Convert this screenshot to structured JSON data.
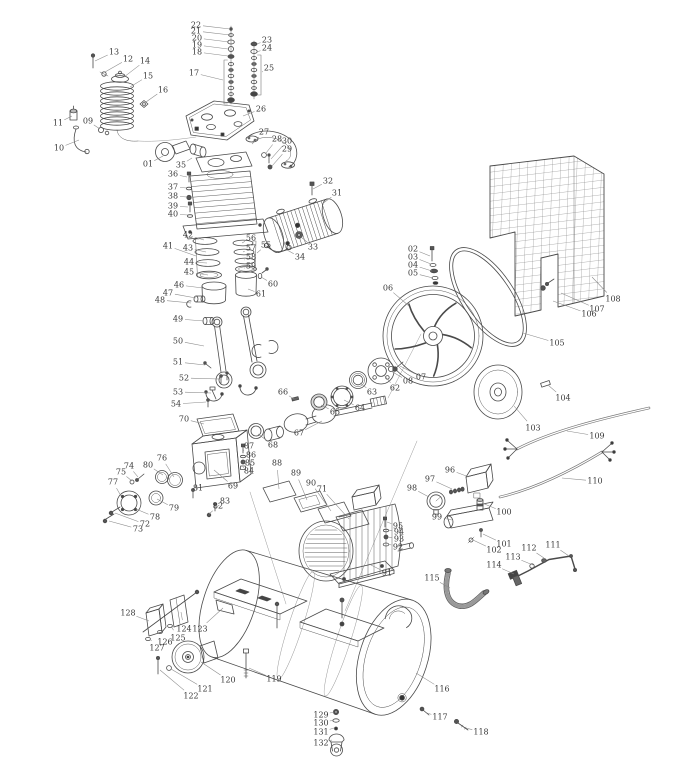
{
  "diagram": {
    "kind": "exploded-parts-diagram",
    "background": "#ffffff",
    "line_color": "#4a4a4a",
    "label_color": "#3a3a3a",
    "callouts": [
      {
        "n": "01",
        "lx": 148,
        "ly": 164,
        "tx": 163,
        "ty": 156
      },
      {
        "n": "02",
        "lx": 413,
        "ly": 249,
        "tx": 430,
        "ty": 256
      },
      {
        "n": "03",
        "lx": 413,
        "ly": 257,
        "tx": 431,
        "ty": 264
      },
      {
        "n": "04",
        "lx": 413,
        "ly": 265,
        "tx": 432,
        "ty": 271
      },
      {
        "n": "05",
        "lx": 413,
        "ly": 273,
        "tx": 433,
        "ty": 278
      },
      {
        "n": "06",
        "lx": 388,
        "ly": 288,
        "tx": 409,
        "ty": 306
      },
      {
        "n": "07",
        "lx": 421,
        "ly": 377,
        "tx": 400,
        "ty": 366
      },
      {
        "n": "08",
        "lx": 408,
        "ly": 381,
        "tx": 391,
        "ty": 371
      },
      {
        "n": "09",
        "lx": 88,
        "ly": 121,
        "tx": 100,
        "ty": 129
      },
      {
        "n": "10",
        "lx": 59,
        "ly": 148,
        "tx": 79,
        "ty": 140
      },
      {
        "n": "11",
        "lx": 58,
        "ly": 123,
        "tx": 72,
        "ty": 116
      },
      {
        "n": "12",
        "lx": 128,
        "ly": 59,
        "tx": 105,
        "ty": 72
      },
      {
        "n": "13",
        "lx": 114,
        "ly": 52,
        "tx": 95,
        "ty": 61
      },
      {
        "n": "14",
        "lx": 145,
        "ly": 61,
        "tx": 124,
        "ty": 77
      },
      {
        "n": "15",
        "lx": 148,
        "ly": 76,
        "tx": 130,
        "ty": 87
      },
      {
        "n": "16",
        "lx": 163,
        "ly": 90,
        "tx": 146,
        "ty": 102
      },
      {
        "n": "17",
        "lx": 194,
        "ly": 73,
        "tx": 223,
        "ty": 80
      },
      {
        "n": "18",
        "lx": 197,
        "ly": 52,
        "tx": 228,
        "ty": 56
      },
      {
        "n": "19",
        "lx": 197,
        "ly": 45,
        "tx": 228,
        "ty": 49
      },
      {
        "n": "20",
        "lx": 197,
        "ly": 38,
        "tx": 229,
        "ty": 42
      },
      {
        "n": "21",
        "lx": 196,
        "ly": 31,
        "tx": 230,
        "ty": 35
      },
      {
        "n": "22",
        "lx": 196,
        "ly": 25,
        "tx": 230,
        "ty": 29
      },
      {
        "n": "23",
        "lx": 267,
        "ly": 40,
        "tx": 257,
        "ty": 44
      },
      {
        "n": "24",
        "lx": 267,
        "ly": 48,
        "tx": 257,
        "ty": 52
      },
      {
        "n": "25",
        "lx": 269,
        "ly": 68,
        "tx": 262,
        "ty": 72
      },
      {
        "n": "26",
        "lx": 261,
        "ly": 109,
        "tx": 243,
        "ty": 116
      },
      {
        "n": "27",
        "lx": 264,
        "ly": 132,
        "tx": 252,
        "ty": 144
      },
      {
        "n": "28",
        "lx": 277,
        "ly": 139,
        "tx": 266,
        "ty": 153
      },
      {
        "n": "29",
        "lx": 287,
        "ly": 149,
        "tx": 272,
        "ty": 166
      },
      {
        "n": "30",
        "lx": 287,
        "ly": 141,
        "tx": 271,
        "ty": 159
      },
      {
        "n": "31",
        "lx": 337,
        "ly": 193,
        "tx": 322,
        "ty": 204
      },
      {
        "n": "32",
        "lx": 328,
        "ly": 181,
        "tx": 313,
        "ty": 189
      },
      {
        "n": "33",
        "lx": 313,
        "ly": 247,
        "tx": 301,
        "ty": 237
      },
      {
        "n": "34",
        "lx": 300,
        "ly": 257,
        "tx": 287,
        "ty": 250
      },
      {
        "n": "35",
        "lx": 181,
        "ly": 165,
        "tx": 192,
        "ty": 158
      },
      {
        "n": "36",
        "lx": 173,
        "ly": 174,
        "tx": 187,
        "ty": 177
      },
      {
        "n": "37",
        "lx": 173,
        "ly": 187,
        "tx": 187,
        "ty": 188
      },
      {
        "n": "38",
        "lx": 173,
        "ly": 196,
        "tx": 187,
        "ty": 197
      },
      {
        "n": "39",
        "lx": 173,
        "ly": 206,
        "tx": 188,
        "ty": 207
      },
      {
        "n": "40",
        "lx": 173,
        "ly": 214,
        "tx": 188,
        "ty": 215
      },
      {
        "n": "41",
        "lx": 168,
        "ly": 246,
        "tx": 196,
        "ty": 256
      },
      {
        "n": "42",
        "lx": 188,
        "ly": 235,
        "tx": 204,
        "ty": 240
      },
      {
        "n": "43",
        "lx": 188,
        "ly": 248,
        "tx": 206,
        "ty": 252
      },
      {
        "n": "44",
        "lx": 189,
        "ly": 262,
        "tx": 207,
        "ty": 263
      },
      {
        "n": "45",
        "lx": 189,
        "ly": 272,
        "tx": 208,
        "ty": 275
      },
      {
        "n": "46",
        "lx": 179,
        "ly": 285,
        "tx": 203,
        "ty": 288
      },
      {
        "n": "47",
        "lx": 168,
        "ly": 293,
        "tx": 196,
        "ty": 298
      },
      {
        "n": "48",
        "lx": 160,
        "ly": 300,
        "tx": 191,
        "ty": 303
      },
      {
        "n": "49",
        "lx": 178,
        "ly": 319,
        "tx": 204,
        "ty": 321
      },
      {
        "n": "50",
        "lx": 178,
        "ly": 341,
        "tx": 204,
        "ty": 346
      },
      {
        "n": "51",
        "lx": 178,
        "ly": 362,
        "tx": 205,
        "ty": 365
      },
      {
        "n": "52",
        "lx": 184,
        "ly": 378,
        "tx": 219,
        "ty": 379
      },
      {
        "n": "53",
        "lx": 178,
        "ly": 392,
        "tx": 211,
        "ty": 393
      },
      {
        "n": "54",
        "lx": 176,
        "ly": 404,
        "tx": 206,
        "ty": 402
      },
      {
        "n": "55",
        "lx": 266,
        "ly": 245,
        "tx": 257,
        "ty": 253
      },
      {
        "n": "56",
        "lx": 251,
        "ly": 238,
        "tx": 242,
        "ty": 243
      },
      {
        "n": "57",
        "lx": 251,
        "ly": 248,
        "tx": 243,
        "ty": 252
      },
      {
        "n": "58",
        "lx": 251,
        "ly": 257,
        "tx": 244,
        "ty": 260
      },
      {
        "n": "59",
        "lx": 251,
        "ly": 266,
        "tx": 245,
        "ty": 268
      },
      {
        "n": "60",
        "lx": 273,
        "ly": 284,
        "tx": 261,
        "ty": 277
      },
      {
        "n": "61",
        "lx": 261,
        "ly": 294,
        "tx": 248,
        "ty": 289
      },
      {
        "n": "62",
        "lx": 395,
        "ly": 388,
        "tx": 384,
        "ty": 375
      },
      {
        "n": "63",
        "lx": 372,
        "ly": 392,
        "tx": 360,
        "ty": 383
      },
      {
        "n": "64",
        "lx": 360,
        "ly": 408,
        "tx": 344,
        "ty": 400
      },
      {
        "n": "65",
        "lx": 335,
        "ly": 412,
        "tx": 321,
        "ty": 405
      },
      {
        "n": "66",
        "lx": 283,
        "ly": 392,
        "tx": 294,
        "ty": 399
      },
      {
        "n": "67",
        "lx": 299,
        "ly": 433,
        "tx": 322,
        "ty": 421
      },
      {
        "n": "68",
        "lx": 273,
        "ly": 445,
        "tx": 258,
        "ty": 434
      },
      {
        "n": "69",
        "lx": 233,
        "ly": 486,
        "tx": 214,
        "ty": 470
      },
      {
        "n": "70",
        "lx": 184,
        "ly": 419,
        "tx": 204,
        "ty": 424
      },
      {
        "n": "71",
        "lx": 322,
        "ly": 489,
        "tx": 349,
        "ty": 519
      },
      {
        "n": "72",
        "lx": 145,
        "ly": 524,
        "tx": 115,
        "ty": 513
      },
      {
        "n": "73",
        "lx": 138,
        "ly": 529,
        "tx": 109,
        "ty": 521
      },
      {
        "n": "74",
        "lx": 129,
        "ly": 466,
        "tx": 138,
        "ty": 477
      },
      {
        "n": "75",
        "lx": 121,
        "ly": 472,
        "tx": 132,
        "ty": 481
      },
      {
        "n": "76",
        "lx": 162,
        "ly": 458,
        "tx": 174,
        "ty": 477
      },
      {
        "n": "77",
        "lx": 113,
        "ly": 482,
        "tx": 121,
        "ty": 496
      },
      {
        "n": "78",
        "lx": 155,
        "ly": 517,
        "tx": 136,
        "ty": 509
      },
      {
        "n": "79",
        "lx": 174,
        "ly": 508,
        "tx": 157,
        "ty": 499
      },
      {
        "n": "80",
        "lx": 148,
        "ly": 465,
        "tx": 163,
        "ty": 475
      },
      {
        "n": "81",
        "lx": 198,
        "ly": 488,
        "tx": 193,
        "ty": 494
      },
      {
        "n": "82",
        "lx": 218,
        "ly": 506,
        "tx": 209,
        "ty": 514
      },
      {
        "n": "83",
        "lx": 225,
        "ly": 501,
        "tx": 215,
        "ty": 508
      },
      {
        "n": "84",
        "lx": 249,
        "ly": 471,
        "tx": 244,
        "ty": 468
      },
      {
        "n": "85",
        "lx": 250,
        "ly": 463,
        "tx": 244,
        "ty": 462
      },
      {
        "n": "86",
        "lx": 251,
        "ly": 455,
        "tx": 244,
        "ty": 456
      },
      {
        "n": "87",
        "lx": 249,
        "ly": 446,
        "tx": 244,
        "ty": 450
      },
      {
        "n": "88",
        "lx": 277,
        "ly": 463,
        "tx": 279,
        "ty": 489
      },
      {
        "n": "89",
        "lx": 296,
        "ly": 473,
        "tx": 307,
        "ty": 500
      },
      {
        "n": "90",
        "lx": 311,
        "ly": 483,
        "tx": 331,
        "ty": 511
      },
      {
        "n": "91",
        "lx": 387,
        "ly": 573,
        "tx": 369,
        "ty": 564
      },
      {
        "n": "92",
        "lx": 398,
        "ly": 547,
        "tx": 388,
        "ty": 544
      },
      {
        "n": "93",
        "lx": 399,
        "ly": 539,
        "tx": 388,
        "ty": 537
      },
      {
        "n": "94",
        "lx": 399,
        "ly": 532,
        "tx": 388,
        "ty": 530
      },
      {
        "n": "95",
        "lx": 398,
        "ly": 526,
        "tx": 387,
        "ty": 522
      },
      {
        "n": "96",
        "lx": 450,
        "ly": 470,
        "tx": 469,
        "ty": 477
      },
      {
        "n": "97",
        "lx": 430,
        "ly": 479,
        "tx": 452,
        "ty": 489
      },
      {
        "n": "98",
        "lx": 412,
        "ly": 488,
        "tx": 429,
        "ty": 497
      },
      {
        "n": "99",
        "lx": 437,
        "ly": 517,
        "tx": 452,
        "ty": 520
      },
      {
        "n": "100",
        "lx": 504,
        "ly": 512,
        "tx": 482,
        "ty": 503
      },
      {
        "n": "101",
        "lx": 504,
        "ly": 544,
        "tx": 483,
        "ty": 534
      },
      {
        "n": "102",
        "lx": 494,
        "ly": 550,
        "tx": 473,
        "ty": 540
      },
      {
        "n": "103",
        "lx": 533,
        "ly": 428,
        "tx": 514,
        "ty": 406
      },
      {
        "n": "104",
        "lx": 563,
        "ly": 398,
        "tx": 548,
        "ty": 385
      },
      {
        "n": "105",
        "lx": 557,
        "ly": 343,
        "tx": 523,
        "ty": 333
      },
      {
        "n": "106",
        "lx": 589,
        "ly": 314,
        "tx": 553,
        "ty": 301
      },
      {
        "n": "107",
        "lx": 597,
        "ly": 309,
        "tx": 561,
        "ty": 293
      },
      {
        "n": "108",
        "lx": 613,
        "ly": 299,
        "tx": 592,
        "ty": 277
      },
      {
        "n": "109",
        "lx": 597,
        "ly": 436,
        "tx": 567,
        "ty": 431
      },
      {
        "n": "110",
        "lx": 595,
        "ly": 481,
        "tx": 562,
        "ty": 478
      },
      {
        "n": "111",
        "lx": 553,
        "ly": 545,
        "tx": 569,
        "ty": 556
      },
      {
        "n": "112",
        "lx": 529,
        "ly": 548,
        "tx": 544,
        "ty": 558
      },
      {
        "n": "113",
        "lx": 513,
        "ly": 557,
        "tx": 533,
        "ty": 565
      },
      {
        "n": "114",
        "lx": 494,
        "ly": 565,
        "tx": 514,
        "ty": 574
      },
      {
        "n": "115",
        "lx": 432,
        "ly": 578,
        "tx": 450,
        "ty": 588
      },
      {
        "n": "116",
        "lx": 442,
        "ly": 689,
        "tx": 416,
        "ty": 673
      },
      {
        "n": "117",
        "lx": 440,
        "ly": 717,
        "tx": 427,
        "ty": 713
      },
      {
        "n": "118",
        "lx": 481,
        "ly": 732,
        "tx": 466,
        "ty": 728
      },
      {
        "n": "119",
        "lx": 274,
        "ly": 679,
        "tx": 249,
        "ty": 668
      },
      {
        "n": "120",
        "lx": 228,
        "ly": 680,
        "tx": 201,
        "ty": 662
      },
      {
        "n": "121",
        "lx": 205,
        "ly": 689,
        "tx": 171,
        "ty": 669
      },
      {
        "n": "122",
        "lx": 191,
        "ly": 696,
        "tx": 160,
        "ty": 670
      },
      {
        "n": "123",
        "lx": 200,
        "ly": 629,
        "tx": 223,
        "ty": 608
      },
      {
        "n": "124",
        "lx": 184,
        "ly": 629,
        "tx": 181,
        "ty": 612
      },
      {
        "n": "125",
        "lx": 178,
        "ly": 638,
        "tx": 171,
        "ty": 626
      },
      {
        "n": "126",
        "lx": 165,
        "ly": 642,
        "tx": 161,
        "ty": 632
      },
      {
        "n": "127",
        "lx": 157,
        "ly": 648,
        "tx": 150,
        "ty": 639
      },
      {
        "n": "128",
        "lx": 128,
        "ly": 613,
        "tx": 149,
        "ty": 621
      },
      {
        "n": "129",
        "lx": 321,
        "ly": 715,
        "tx": 334,
        "ty": 712
      },
      {
        "n": "130",
        "lx": 321,
        "ly": 723,
        "tx": 334,
        "ty": 720
      },
      {
        "n": "131",
        "lx": 321,
        "ly": 732,
        "tx": 334,
        "ty": 728
      },
      {
        "n": "132",
        "lx": 321,
        "ly": 743,
        "tx": 332,
        "ty": 740
      }
    ]
  }
}
